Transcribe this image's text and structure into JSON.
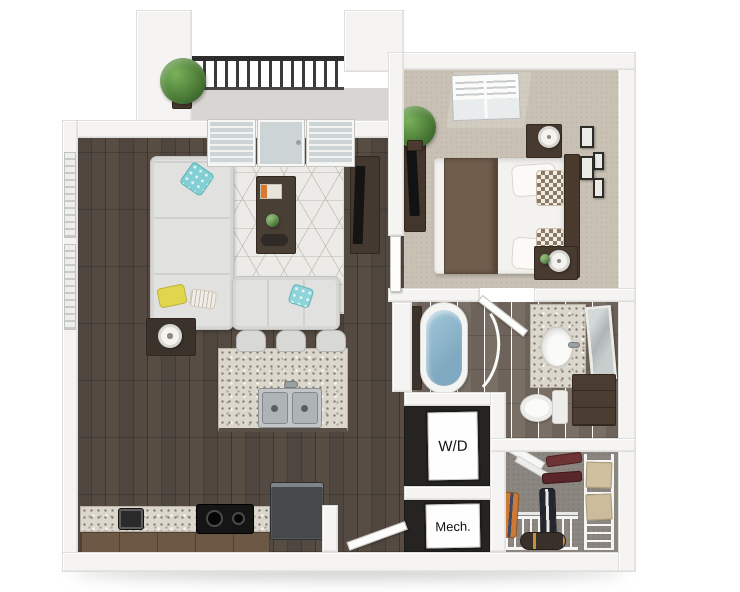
{
  "floorplan": {
    "description": "3D rendered one-bedroom apartment floor plan",
    "labels": {
      "washer_dryer": "W/D",
      "mechanical": "Mech."
    },
    "colors": {
      "background": "#ffffff",
      "walls": "#f5f4f2",
      "wood_floor": "#4a423b",
      "bathroom_tile": "#6e645b",
      "bedroom_carpet": "#c9c1b4",
      "closet_carpet": "#8b8680",
      "balcony_floor": "#d8d6d2",
      "granite_counter": "#dcd7cd",
      "bathtub_water": "#8cb6cc",
      "sofa": "#e1e1e0",
      "accent_pillow_teal": "#82cfd4",
      "accent_pillow_yellow": "#e0d64d",
      "railing": "#383838",
      "dark_wood_furniture": "#473a2f",
      "appliance_label_bg": "#fefefe",
      "label_text": "#111111"
    }
  }
}
